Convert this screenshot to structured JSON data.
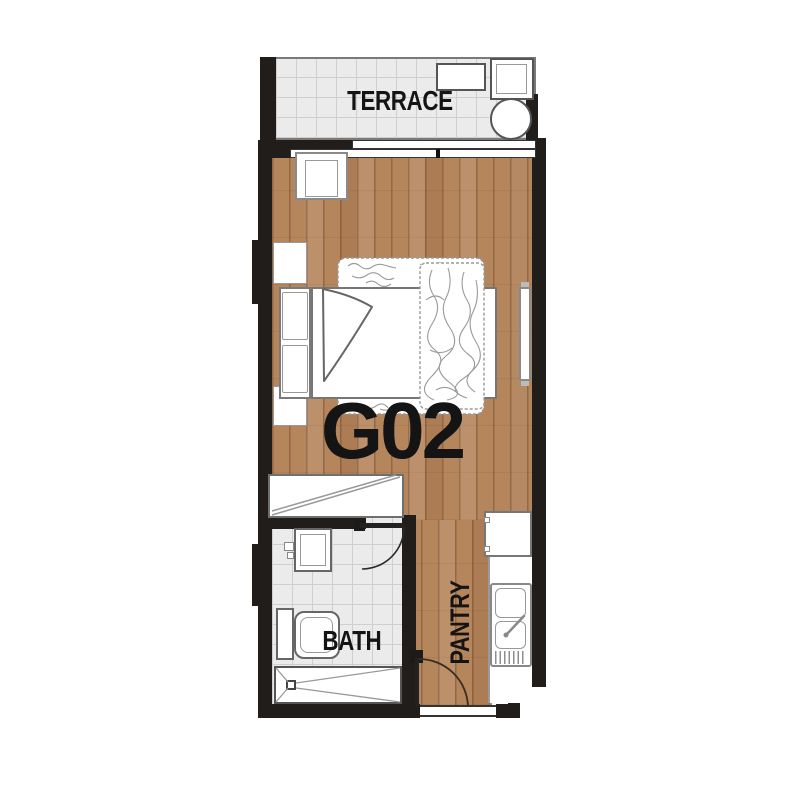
{
  "unit_label": "G02",
  "rooms": {
    "terrace": {
      "label": "TERRACE"
    },
    "bath": {
      "label": "BATH"
    },
    "pantry": {
      "label": "PANTRY"
    }
  },
  "colors": {
    "wall": "#201d1b",
    "wood_floor": "#b5855c",
    "tile_floor": "#ebebeb",
    "tile_grid_line": "#cfcfcf",
    "furniture_outline": "#6f6f6f",
    "label_text": "#141414",
    "background": "#ffffff"
  },
  "furniture_symbols": [
    "lounge-bench",
    "armchair",
    "round-table",
    "side-table",
    "bed-with-pillows",
    "rumpled-duvet",
    "wall-shelf",
    "wardrobe",
    "bathroom-sink",
    "toilet",
    "shower-with-drain",
    "kitchen-counter",
    "fridge",
    "kitchen-sink",
    "swing-door",
    "sliding-glass-door"
  ]
}
